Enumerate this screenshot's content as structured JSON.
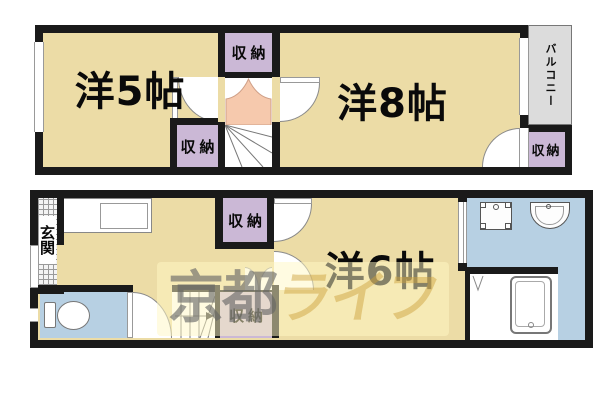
{
  "plan": {
    "title": "2-story apartment floor plan",
    "upper_floor": {
      "rooms": [
        {
          "name": "western-room-5",
          "label": "洋5帖"
        },
        {
          "name": "western-room-8",
          "label": "洋8帖"
        },
        {
          "name": "balcony",
          "label": "バルコニー"
        },
        {
          "name": "storage-top-center",
          "label": "収納"
        },
        {
          "name": "storage-bottom-center",
          "label": "収納"
        },
        {
          "name": "storage-balcony-side",
          "label": "収納"
        }
      ]
    },
    "lower_floor": {
      "rooms": [
        {
          "name": "entrance",
          "label": "玄関"
        },
        {
          "name": "western-room-6",
          "label": "洋6帖"
        },
        {
          "name": "storage-hall-upper",
          "label": "収納"
        },
        {
          "name": "storage-hall-lower",
          "label": "収納"
        }
      ]
    },
    "watermark": {
      "text": "京都ライフ",
      "prefix": "京都",
      "suffix": "ライフ"
    },
    "colors": {
      "room_floor": "#ecdca6",
      "storage": "#cbb8d6",
      "stair_landing": "#f6c9ad",
      "water_area": "#b7d0e3",
      "balcony": "#dcdcdc",
      "wall": "#1a1a1a",
      "watermark_bg": "#fff7c3",
      "watermark_gray": "#646464",
      "watermark_gold": "#cda03c"
    }
  }
}
